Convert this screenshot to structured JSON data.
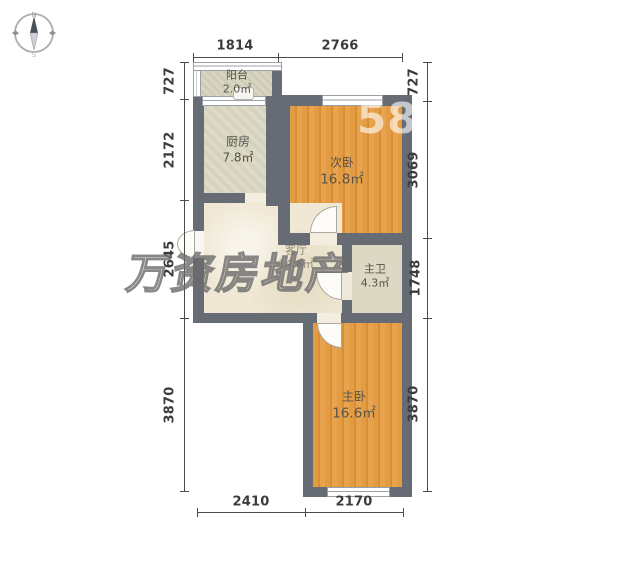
{
  "compass": {
    "north_label": "N",
    "south_label": "S"
  },
  "dimensions": {
    "top": [
      "1814",
      "2766"
    ],
    "left": [
      "727",
      "2172",
      "2645",
      "3870"
    ],
    "right": [
      "727",
      "3069",
      "1748",
      "3870"
    ],
    "bottom": [
      "2410",
      "2170"
    ]
  },
  "rooms": {
    "balcony": {
      "name": "阳台",
      "area": "2.0㎡"
    },
    "kitchen": {
      "name": "厨房",
      "area": "7.8㎡"
    },
    "second_bedroom": {
      "name": "次卧",
      "area": "16.8㎡"
    },
    "living_room": {
      "name": "客厅",
      "area": "14.8㎡"
    },
    "master_bathroom": {
      "name": "主卫",
      "area": "4.3㎡"
    },
    "master_bedroom": {
      "name": "主卧",
      "area": "16.6㎡"
    }
  },
  "watermarks": {
    "agency": "万资房地产",
    "site": "58"
  },
  "colors": {
    "wall": "#676b74",
    "wood_floor": "#e0953c",
    "light_floor": "#d8d5c0",
    "living_floor": "#f0e8d4",
    "dimension_text": "#3c3c3c",
    "watermark_outline": "#6a6a6a",
    "watermark_site": "#ffffff"
  }
}
